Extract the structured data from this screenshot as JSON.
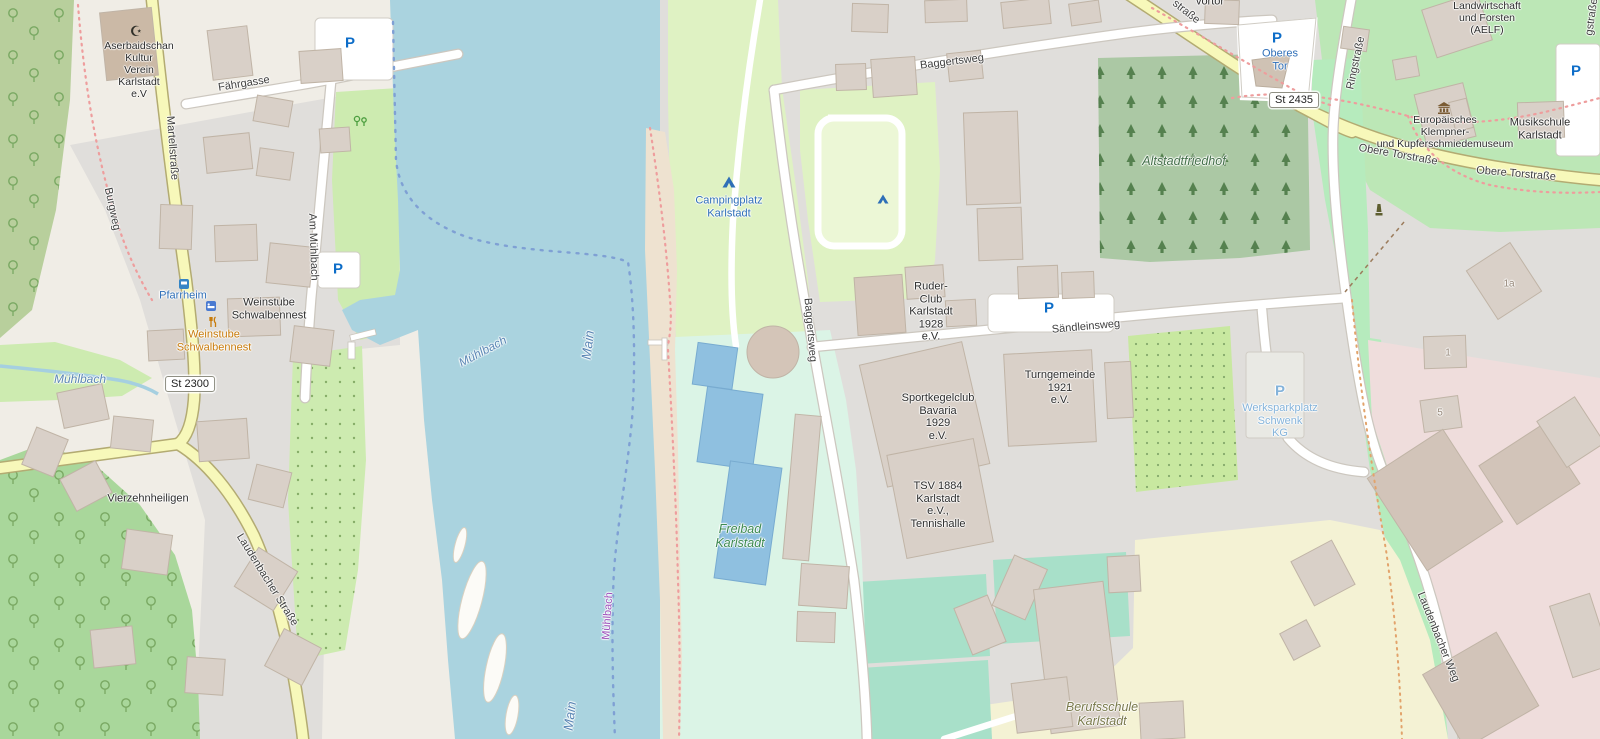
{
  "map": {
    "place": "Karlstadt am Main",
    "labels": {
      "kultur_verein": "Aserbaidschan\nKultur\nVerein\nKarlstadt\ne.V",
      "faehrgasse": "Fährgasse",
      "martellstrasse": "Martellstraße",
      "burgweg": "Burgweg",
      "pfarrheim": "Pfarrheim",
      "weinstube_name": "Weinstube\nSchwalbennest",
      "weinstube_poi": "Weinstube\nSchwalbennest",
      "am_muehlbach": "Am Mühlbach",
      "muehlbach_stream": "Mühlbach",
      "muehlbach_river": "Mühlbach",
      "muehlbach_boundary": "Mühlbach",
      "main_upper": "Main",
      "main_lower": "Main",
      "vierzehnheiligen": "Vierzehnheiligen",
      "laudenbacher_strasse": "Laudenbacher Straße",
      "laudenbacher_weg": "Laudenbacher Weg",
      "campingplatz": "Campingplatz\nKarlstadt",
      "baggertsweg_h": "Baggertsweg",
      "baggertsweg_v": "Baggertsweg",
      "altstadtfriedhof": "Altstadtfriedhof",
      "ruder_club": "Ruder-\nClub\nKarlstadt\n1928\ne.V.",
      "saendleinsweg": "Sändleinsweg",
      "sportkegelclub": "Sportkegelclub\nBavaria\n1929\ne.V.",
      "turngemeinde": "Turngemeinde\n1921\ne.V.",
      "tsv": "TSV 1884\nKarlstadt\ne.V.,\nTennishalle",
      "freibad": "Freibad\nKarlstadt",
      "berufsschule": "Berufsschule\nKarlstadt",
      "werksparkplatz": "Werksparkplatz\nSchwenk\nKG",
      "oberes_tor": "Oberes\nTor",
      "ringstrasse": "Ringstraße",
      "ringstrasse_fragment": "gstraße",
      "strasse_fragment": "straße",
      "vortor_fragment": "vortor",
      "obere_torstrasse_1": "Obere Torstraße",
      "obere_torstrasse_2": "Obere Torstraße",
      "museum": "Europäisches\nKlempner-\nund Kupferschmiedemuseum",
      "musikschule": "Musikschule\nKarlstadt",
      "aelf": "Ernährung,\nLandwirtschaft\nund Forsten\n(AELF)"
    },
    "shields": {
      "st2300": "St 2300",
      "st2435": "St 2435"
    },
    "house_numbers": {
      "h1a": "1a",
      "h1": "1",
      "h5": "5"
    },
    "icons": {
      "parking": "P",
      "mosque": "☪",
      "campsite": "campsite-tent-icon",
      "museum": "museum-icon",
      "restaurant": "restaurant-icon",
      "guesthouse": "guesthouse-icon",
      "bus_stop": "bus-stop-icon",
      "memorial": "memorial-icon",
      "park": "park-trees-icon"
    },
    "colors": {
      "water": "#aad3df",
      "residential": "#e0dedb",
      "meadow": "#cdebb0",
      "campsite": "#dff2c3",
      "cemetery": "#abc8a4",
      "park_green": "#bce7b6",
      "pitch": "#a8e0c9",
      "freibad": "#dbf4e6",
      "school": "#f4f2d4",
      "industrial": "#efdddc",
      "road_yellow": "#f7f8ba",
      "building": "#d9d0c8",
      "poi_blue": "#2f6fb8",
      "boundary_blue": "#7fa0d4",
      "path_red": "#ee9d9d"
    }
  }
}
